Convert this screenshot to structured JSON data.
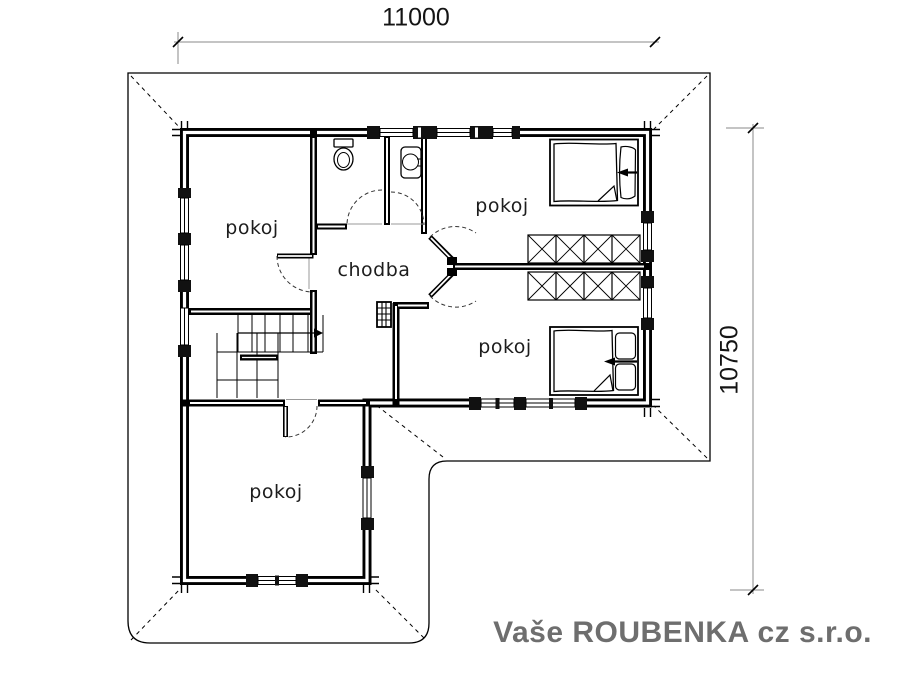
{
  "meta": {
    "title": "floor-plan",
    "background_color": "#ffffff",
    "line_color": "#000000",
    "dimension_line_color": "#8a8a8a",
    "text_color": "#1d1d1d"
  },
  "dimensions": {
    "top": {
      "label": "11000"
    },
    "right": {
      "label": "10750"
    }
  },
  "rooms": [
    {
      "id": "pokoj-top-left",
      "label": "pokoj"
    },
    {
      "id": "pokoj-top-right",
      "label": "pokoj"
    },
    {
      "id": "chodba",
      "label": "chodba"
    },
    {
      "id": "pokoj-bottom-right",
      "label": "pokoj"
    },
    {
      "id": "pokoj-bottom",
      "label": "pokoj"
    }
  ],
  "fixtures": [
    "staircase",
    "wc-toilet",
    "washbasin",
    "stove-chimney",
    "double-bed",
    "double-bed",
    "wardrobe-row",
    "wardrobe-row"
  ],
  "branding": {
    "company": "Vaše ROUBENKA cz s.r.o.",
    "color": "#6e6e6e"
  }
}
